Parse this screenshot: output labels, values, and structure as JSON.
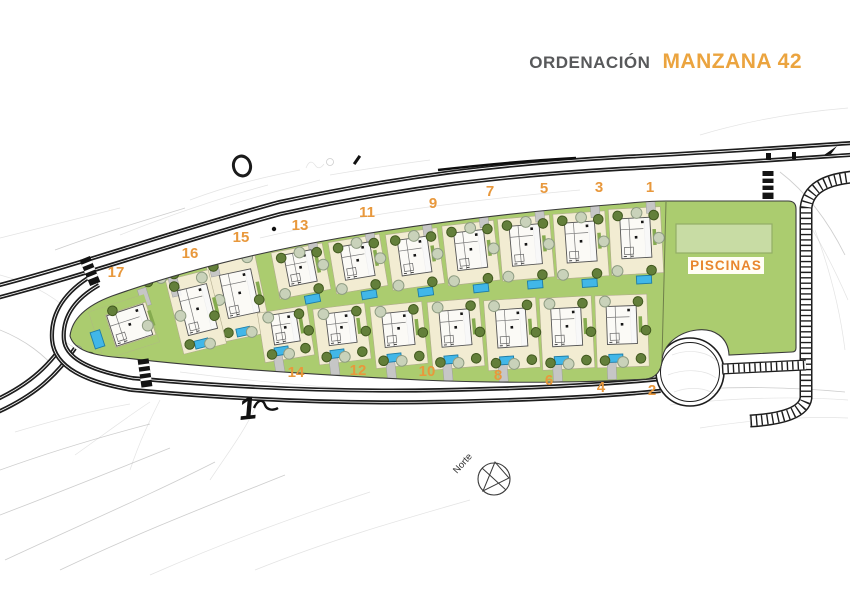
{
  "title": {
    "prefix": "ORDENACIÓN",
    "name": "MANZANA 42"
  },
  "plan": {
    "piscinas_label": "PISCINAS",
    "north_label": "Norte",
    "road_mark": "1",
    "colors": {
      "accent_orange": "#e8983c",
      "title_gray": "#58595b",
      "garden_green": "#abcc6f",
      "plot_cream": "#f2ecd2",
      "pool_blue": "#41b7e8",
      "big_pool_green": "#c8dca4",
      "road_black": "#1d1d1d"
    },
    "plot_labels": [
      {
        "n": "1",
        "x": 650,
        "y": 192
      },
      {
        "n": "3",
        "x": 599,
        "y": 192
      },
      {
        "n": "5",
        "x": 544,
        "y": 193
      },
      {
        "n": "7",
        "x": 490,
        "y": 196
      },
      {
        "n": "9",
        "x": 433,
        "y": 208
      },
      {
        "n": "11",
        "x": 367,
        "y": 217
      },
      {
        "n": "13",
        "x": 300,
        "y": 230
      },
      {
        "n": "15",
        "x": 241,
        "y": 242
      },
      {
        "n": "16",
        "x": 190,
        "y": 258
      },
      {
        "n": "17",
        "x": 116,
        "y": 277
      },
      {
        "n": "14",
        "x": 296,
        "y": 377
      },
      {
        "n": "12",
        "x": 358,
        "y": 375
      },
      {
        "n": "10",
        "x": 427,
        "y": 376
      },
      {
        "n": "8",
        "x": 498,
        "y": 380
      },
      {
        "n": "6",
        "x": 549,
        "y": 385
      },
      {
        "n": "4",
        "x": 601,
        "y": 392
      },
      {
        "n": "2",
        "x": 652,
        "y": 395
      }
    ],
    "plots": [
      {
        "n": "1",
        "cx": 636,
        "cy": 241,
        "w": 52,
        "h": 66,
        "rot": -3,
        "row": "t",
        "vw": 30,
        "vh": 40
      },
      {
        "n": "3",
        "cx": 581,
        "cy": 245,
        "w": 52,
        "h": 65,
        "rot": -4,
        "row": "t",
        "vw": 30,
        "vh": 40
      },
      {
        "n": "5",
        "cx": 526,
        "cy": 248,
        "w": 52,
        "h": 62,
        "rot": -5,
        "row": "t",
        "vw": 30,
        "vh": 40
      },
      {
        "n": "7",
        "cx": 471,
        "cy": 253,
        "w": 52,
        "h": 60,
        "rot": -6.5,
        "row": "t",
        "vw": 30,
        "vh": 38
      },
      {
        "n": "9",
        "cx": 415,
        "cy": 259,
        "w": 52,
        "h": 56,
        "rot": -8,
        "row": "t",
        "vw": 30,
        "vh": 36
      },
      {
        "n": "11",
        "cx": 358,
        "cy": 264,
        "w": 52,
        "h": 52,
        "rot": -9.5,
        "row": "t",
        "vw": 30,
        "vh": 34
      },
      {
        "n": "13",
        "cx": 301,
        "cy": 271,
        "w": 52,
        "h": 47,
        "rot": -11,
        "row": "t",
        "vw": 28,
        "vh": 32
      },
      {
        "n": "15",
        "cx": 238,
        "cy": 296,
        "w": 50,
        "h": 84,
        "rot": -12,
        "row": "s",
        "vw": 32,
        "vh": 44
      },
      {
        "n": "16",
        "cx": 196,
        "cy": 312,
        "w": 44,
        "h": 76,
        "rot": -14,
        "row": "s",
        "vw": 30,
        "vh": 46
      },
      {
        "n": "17",
        "cx": 124,
        "cy": 327,
        "w": 58,
        "h": 50,
        "rot": -18,
        "row": "tip",
        "vw": 38,
        "vh": 32
      },
      {
        "n": "2",
        "cx": 622,
        "cy": 331,
        "w": 52,
        "h": 72,
        "rot": -2,
        "row": "b",
        "vw": 30,
        "vh": 38
      },
      {
        "n": "4",
        "cx": 567,
        "cy": 333,
        "w": 52,
        "h": 72,
        "rot": -3,
        "row": "b",
        "vw": 30,
        "vh": 38
      },
      {
        "n": "6",
        "cx": 512,
        "cy": 334,
        "w": 52,
        "h": 70,
        "rot": -4,
        "row": "b",
        "vw": 30,
        "vh": 38
      },
      {
        "n": "8",
        "cx": 456,
        "cy": 334,
        "w": 52,
        "h": 68,
        "rot": -5,
        "row": "b",
        "vw": 30,
        "vh": 36
      },
      {
        "n": "10",
        "cx": 399,
        "cy": 335,
        "w": 52,
        "h": 62,
        "rot": -6,
        "row": "b",
        "vw": 30,
        "vh": 34
      },
      {
        "n": "12",
        "cx": 342,
        "cy": 334,
        "w": 52,
        "h": 56,
        "rot": -7,
        "row": "b",
        "vw": 28,
        "vh": 32
      },
      {
        "n": "14",
        "cx": 286,
        "cy": 334,
        "w": 50,
        "h": 50,
        "rot": -9,
        "row": "b",
        "vw": 26,
        "vh": 30
      }
    ],
    "extra_trees": [
      {
        "x": 64,
        "y": 331,
        "t": "p"
      },
      {
        "x": 69,
        "y": 318,
        "t": "d"
      },
      {
        "x": 79,
        "y": 308,
        "t": "p"
      },
      {
        "x": 91,
        "y": 300,
        "t": "d"
      },
      {
        "x": 103,
        "y": 293,
        "t": "p"
      },
      {
        "x": 148,
        "y": 282,
        "t": "d"
      },
      {
        "x": 161,
        "y": 278,
        "t": "p"
      },
      {
        "x": 174,
        "y": 274,
        "t": "d"
      },
      {
        "x": 67,
        "y": 343,
        "t": "d"
      },
      {
        "x": 77,
        "y": 351,
        "t": "p"
      },
      {
        "x": 90,
        "y": 357,
        "t": "d"
      },
      {
        "x": 103,
        "y": 362,
        "t": "p"
      },
      {
        "x": 117,
        "y": 365,
        "t": "d"
      },
      {
        "x": 131,
        "y": 368,
        "t": "p"
      },
      {
        "x": 146,
        "y": 370,
        "t": "d"
      },
      {
        "x": 161,
        "y": 372,
        "t": "p"
      },
      {
        "x": 176,
        "y": 373,
        "t": "d"
      },
      {
        "x": 190,
        "y": 375,
        "t": "p"
      }
    ],
    "big_pool": {
      "x": 676,
      "y": 224,
      "w": 96,
      "h": 29
    },
    "piscinas_pos": {
      "x": 726,
      "y": 270
    }
  }
}
